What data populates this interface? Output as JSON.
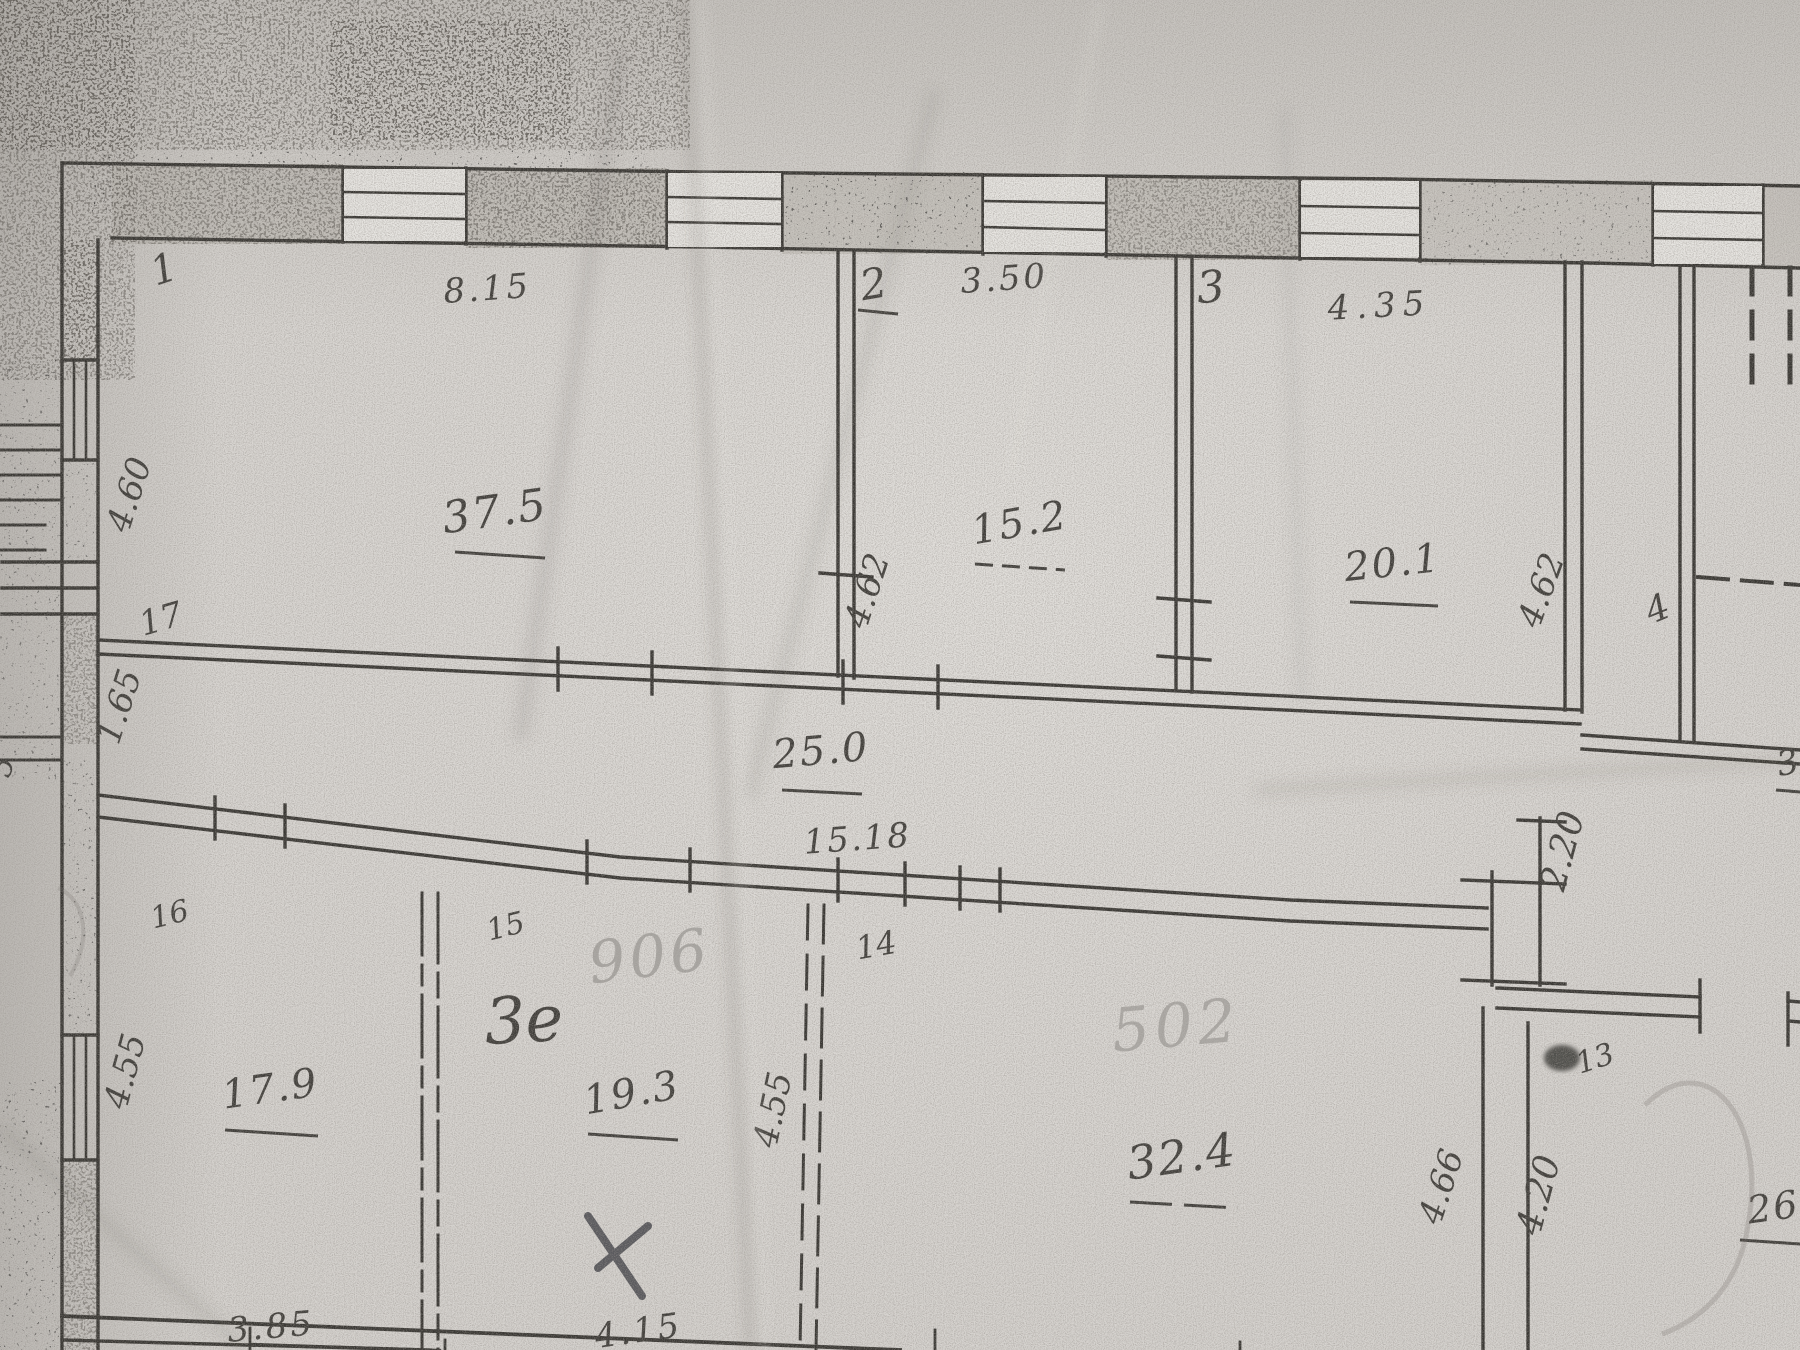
{
  "document_kind": "photographed hand-drawn floor plan (technical inventory sheet)",
  "rooms": [
    {
      "number": "1",
      "top_dim": "8.15",
      "side_dim": "4.60",
      "area": "37.5"
    },
    {
      "number": "2",
      "top_dim": "3.50",
      "side_dim": "4.62",
      "area": "15.2"
    },
    {
      "number": "3",
      "top_dim": "4.35",
      "side_dim": "4.62",
      "area": "20.1"
    },
    {
      "number": "4"
    },
    {
      "number": "17",
      "width_dim": "1.65",
      "area": "25.0",
      "length_dim": "15.18",
      "door_dim": "2.20"
    },
    {
      "number": "16",
      "side_dim": "4.55",
      "area": "17.9",
      "bottom_dim": "3.85"
    },
    {
      "number": "15",
      "pen_note": "3е",
      "pencil_note": "906",
      "area": "19.3",
      "side_dim": "4.55",
      "bottom_dim": "4.15"
    },
    {
      "number": "14",
      "pencil_note": "502",
      "area": "32.4",
      "side_dim": "4.66"
    },
    {
      "number": "13",
      "side_dim": "4.20",
      "area_partial": "26"
    }
  ],
  "partials": {
    "left_edge_dim": "5",
    "right_edge_area": "3"
  },
  "marks": {
    "pen_cross": "pen-x-mark",
    "ink_smudge": "ink-smudge",
    "window_symbol": "window-symbol",
    "door_symbol": "door-tick-symbol"
  },
  "colors": {
    "paper": "#d6d3cf",
    "ink": "#383632",
    "pencil": "#6e6962",
    "pen": "#3a3a40"
  }
}
